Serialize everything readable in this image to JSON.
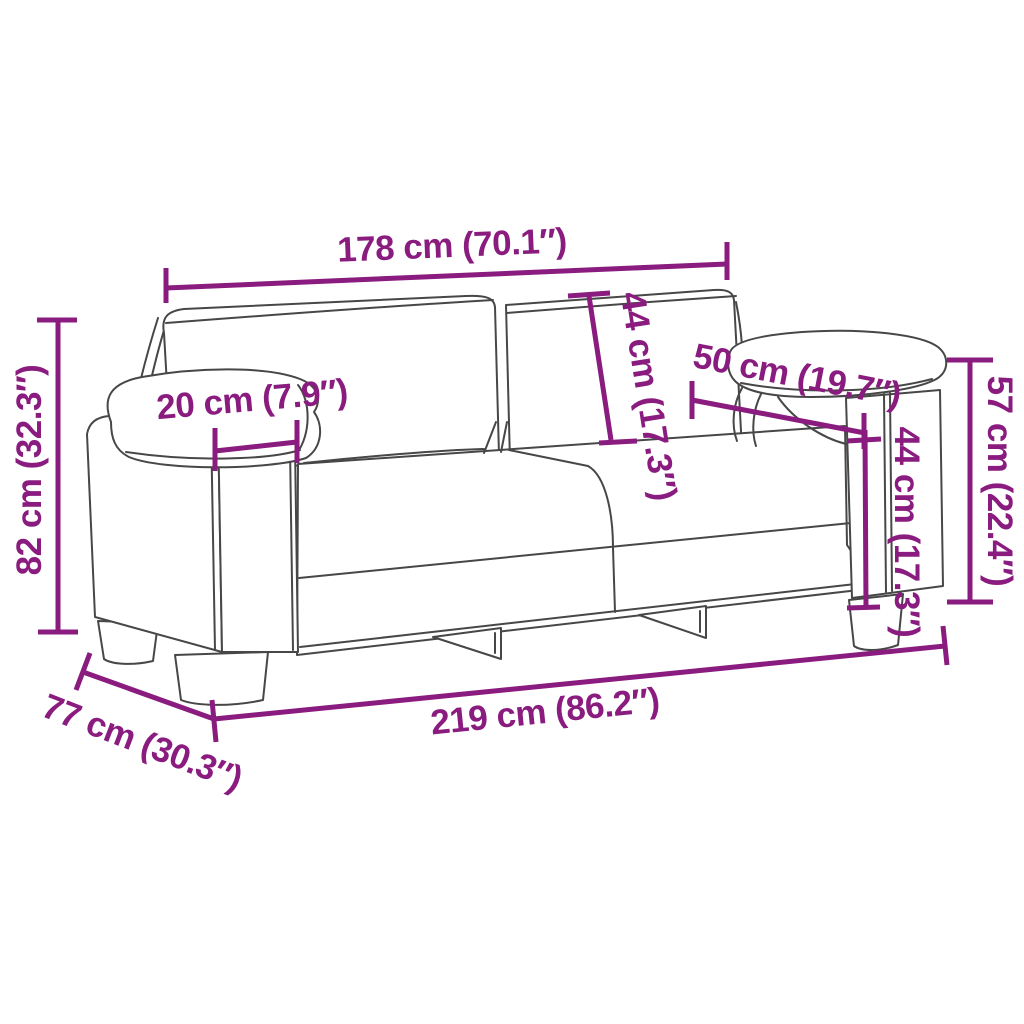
{
  "diagram": {
    "title": "Sofa dimensions diagram",
    "subject": "2-seater sofa line drawing with measurement annotations",
    "colors": {
      "dimension": "#8A1B7F",
      "outline": "#474747",
      "background": "#ffffff"
    },
    "units": {
      "primary": "cm",
      "secondary": "in"
    },
    "dimensions": [
      {
        "id": "width-without-armrests",
        "value_cm": 178,
        "value_in": 70.1,
        "label": "178 cm (70.1″)"
      },
      {
        "id": "back-cushion-height",
        "value_cm": 44,
        "value_in": 17.3,
        "label": "44 cm (17.3″)"
      },
      {
        "id": "armrest-depth",
        "value_cm": 50,
        "value_in": 19.7,
        "label": "50 cm (19.7″)"
      },
      {
        "id": "armrest-width",
        "value_cm": 20,
        "value_in": 7.9,
        "label": "20 cm (7.9″)"
      },
      {
        "id": "overall-height",
        "value_cm": 82,
        "value_in": 32.3,
        "label": "82 cm (32.3″)"
      },
      {
        "id": "armrest-height",
        "value_cm": 57,
        "value_in": 22.4,
        "label": "57 cm (22.4″)"
      },
      {
        "id": "seat-height",
        "value_cm": 44,
        "value_in": 17.3,
        "label": "44 cm (17.3″)"
      },
      {
        "id": "overall-width",
        "value_cm": 219,
        "value_in": 86.2,
        "label": "219 cm (86.2″)"
      },
      {
        "id": "overall-depth",
        "value_cm": 77,
        "value_in": 30.3,
        "label": "77 cm (30.3″)"
      }
    ]
  }
}
